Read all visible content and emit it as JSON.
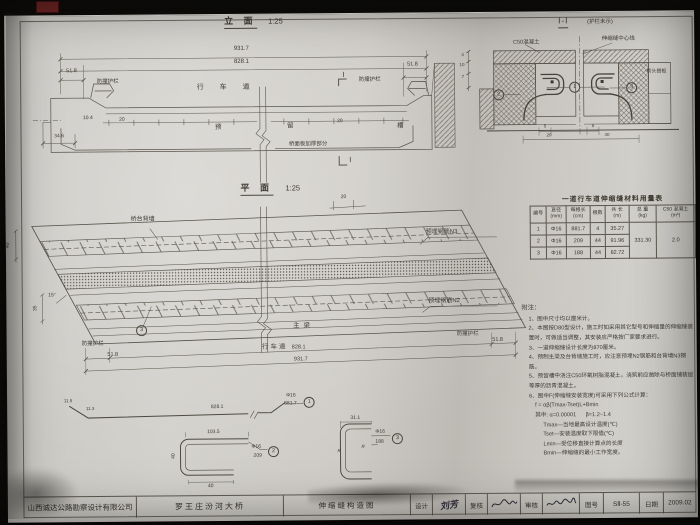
{
  "elevation": {
    "title": "立 面",
    "scale": "1:25",
    "dim_total": "931.7",
    "dim_inner": "828.1",
    "dim_left": "51.8",
    "dim_right": "51.8",
    "guard_left": "防撞护栏",
    "guard_right": "防撞护栏",
    "roadway": "行 车 道",
    "slot1": "预",
    "slot2": "留",
    "slot3": "槽",
    "deck_note": "桥面板加厚部分",
    "d104": "10.4",
    "d20a": "20",
    "d20b": "20",
    "d346": "34.6",
    "sec_top": "Ⅰ",
    "sec_bot": "Ⅰ"
  },
  "section": {
    "title": "Ⅰ-Ⅰ",
    "subtitle": "(护栏未示)",
    "c50": "C50混凝土",
    "centerline": "伸缩缝中心线",
    "slab": "桥头搭板",
    "c1": "1",
    "c2": "2",
    "c3": "3",
    "dl1": "4",
    "dl2": "10",
    "dl3": "7",
    "db1": "5",
    "db2": "5",
    "d20": "20",
    "d40": "40"
  },
  "plan": {
    "title": "平 面",
    "scale": "1:25",
    "backwall": "桥台背墙",
    "n3": "预埋钢筋N3",
    "n2": "预埋钢筋N2",
    "girder": "主梁",
    "roadway": "行车道",
    "guard_left": "防撞护栏",
    "guard_right": "防撞护栏",
    "c3": "3",
    "d20": "20",
    "d40": "40",
    "d35": "35",
    "angle": "15°",
    "dim_left": "51.8",
    "dim_inner": "828.1",
    "dim_right": "51.8",
    "dim_total": "931.7"
  },
  "rebar": {
    "b1": {
      "d1": "11.5",
      "d2": "11.3",
      "len": "828.1",
      "spec": "Φ16",
      "total": "881.7",
      "no": "1"
    },
    "b2": {
      "top": "103.5",
      "left": "40",
      "bottom": "40",
      "spec": "Φ16",
      "total": "209",
      "no": "2"
    },
    "b3": {
      "top": "31.1",
      "r1": "R",
      "r2": "R",
      "spec": "Φ16",
      "total": "188",
      "no": "3"
    }
  },
  "table": {
    "title": "一道行车道伸缩缝材料用量表",
    "headers": [
      {
        "t": "编号",
        "u": ""
      },
      {
        "t": "直径",
        "u": "(mm)"
      },
      {
        "t": "每根长",
        "u": "(cm)"
      },
      {
        "t": "根数",
        "u": ""
      },
      {
        "t": "共 长",
        "u": "(m)"
      },
      {
        "t": "总 重",
        "u": "(kg)"
      },
      {
        "t": "C50 混凝土",
        "u": "(m³)"
      }
    ],
    "rows": [
      [
        "1",
        "Φ16",
        "881.7",
        "4",
        "35.27"
      ],
      [
        "2",
        "Φ16",
        "209",
        "44",
        "91.96"
      ],
      [
        "3",
        "Φ16",
        "188",
        "44",
        "82.72"
      ]
    ],
    "total_weight": "331.30",
    "concrete": "2.0"
  },
  "notes": {
    "title": "附注：",
    "items": [
      "1、图中尺寸均以厘米计。",
      "2、本图按D80型设计，施工时如采用其它型号和伸缩量的伸缩缝装置时，可做适当调整，其安装应严格按厂家要求进行。",
      "3、一道伸缩缝设计长度为870厘米。",
      "4、预制主梁及台背墙施工时，应注意预埋N2钢筋和台背墙N3钢筋。",
      "5、预留槽中浇注C50环氧树脂混凝土，浇筑前应凿除与桥面铺装层等厚的沥青混凝土。",
      "6、图中F(伸缩缝安装宽度)可采用下列公式计算："
    ],
    "formula": "f = αβ(Tmax-Tset)L+Bmin",
    "params": "其中: α=0.00001      β=1.2~1.4",
    "defs": [
      "Tmax—当地最高设计温度(℃)",
      "Tset—安装温度取下限值(℃)",
      "Lmin—受位移直接计算点的长度",
      "Bmin—伸缩缝的最小工作宽度。"
    ]
  },
  "titleblock": {
    "company": "山西诚达公路勘察设计有限公司",
    "project": "罗王庄汾河大桥",
    "drawing_title": "伸缩缝构造图",
    "f_design": "设计",
    "v_design": "刘芳",
    "f_check": "复核",
    "f_review": "审核",
    "f_no": "图号",
    "v_no": "SⅡ-55",
    "f_date": "日期",
    "v_date": "2009.02"
  }
}
